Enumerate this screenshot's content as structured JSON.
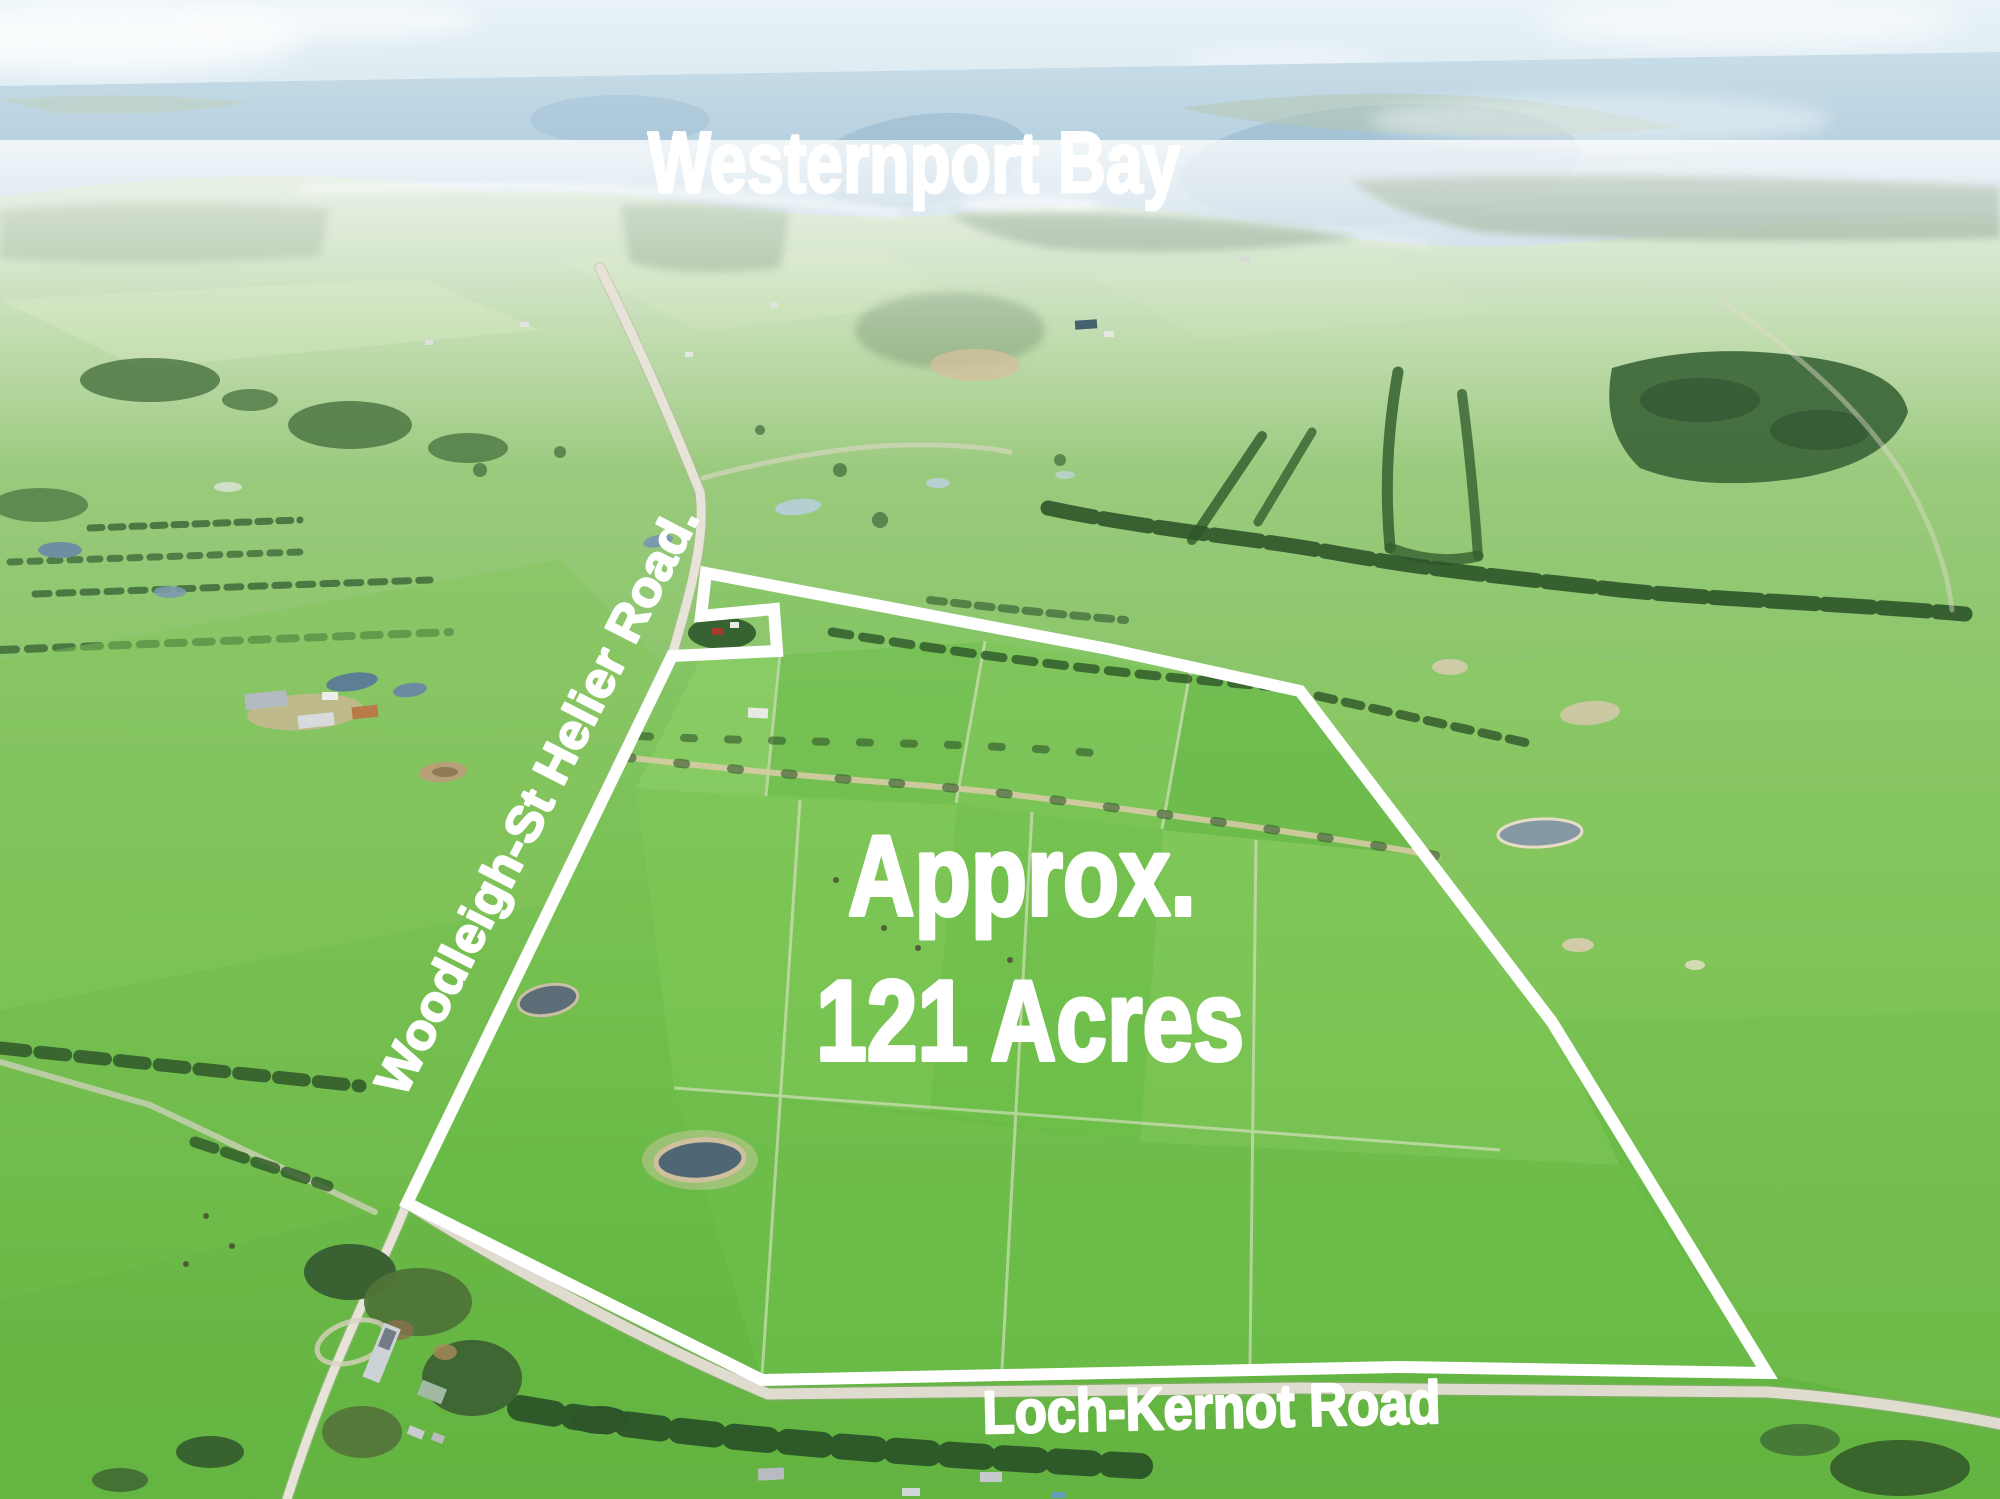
{
  "scene": {
    "description": "Aerial drone photograph of green farmland for sale with white property boundary overlay, looking north toward Westernport Bay",
    "annotation_color": "#ffffff"
  },
  "labels": {
    "bay": "Westernport Bay",
    "area_line_1": "Approx.",
    "area_line_2": "121 Acres",
    "road_vertical": "Woodleigh-St Helier Road.",
    "road_bottom": "Loch-Kernot Road"
  },
  "boundary": {
    "points": "706,573 1108,649 1300,691 1552,1022 1767,1373 1400,1367 762,1380 407,1203 672,656 777,651 774,609 701,616",
    "stroke_color": "#ffffff",
    "stroke_width": "12"
  }
}
